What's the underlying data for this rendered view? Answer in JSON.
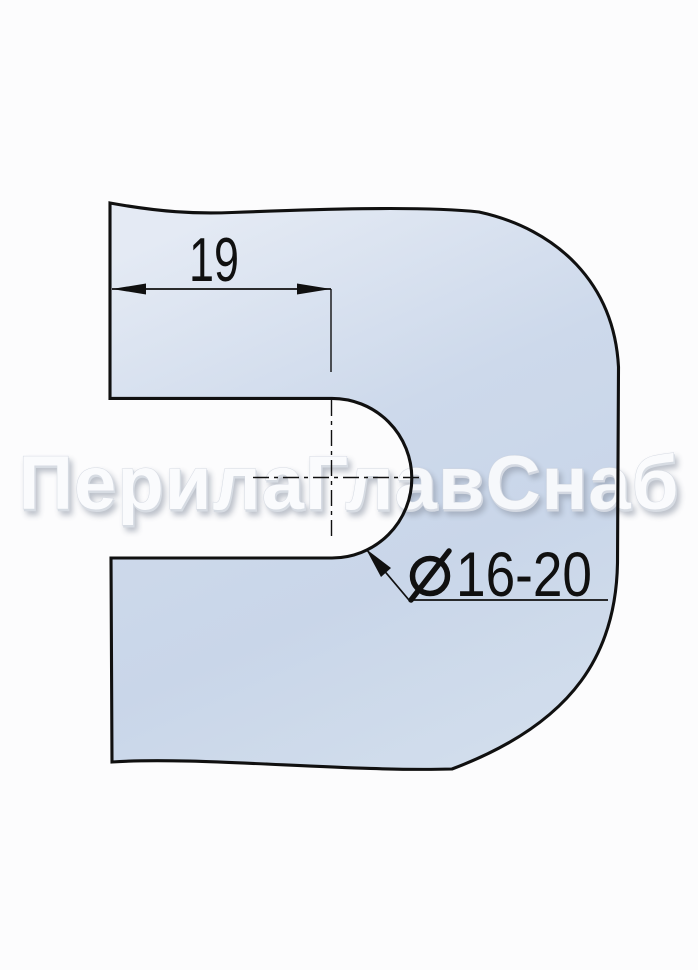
{
  "watermark": "ПерилаГлавСнаб",
  "dimensions": {
    "width": {
      "value": "19"
    },
    "diameter": {
      "symbol": "⌀",
      "value": "16-20",
      "label": "⌀16-20"
    }
  },
  "colors": {
    "line-color": "#101010",
    "fill-top": "#e4eaf4",
    "fill-mid": "#cdd9eb",
    "fill-bottom": "#c9d6e9",
    "fill-bottom2": "#d1ddec",
    "watermark-color": "#fafbfd",
    "bg-color": "#fcfcfd"
  }
}
